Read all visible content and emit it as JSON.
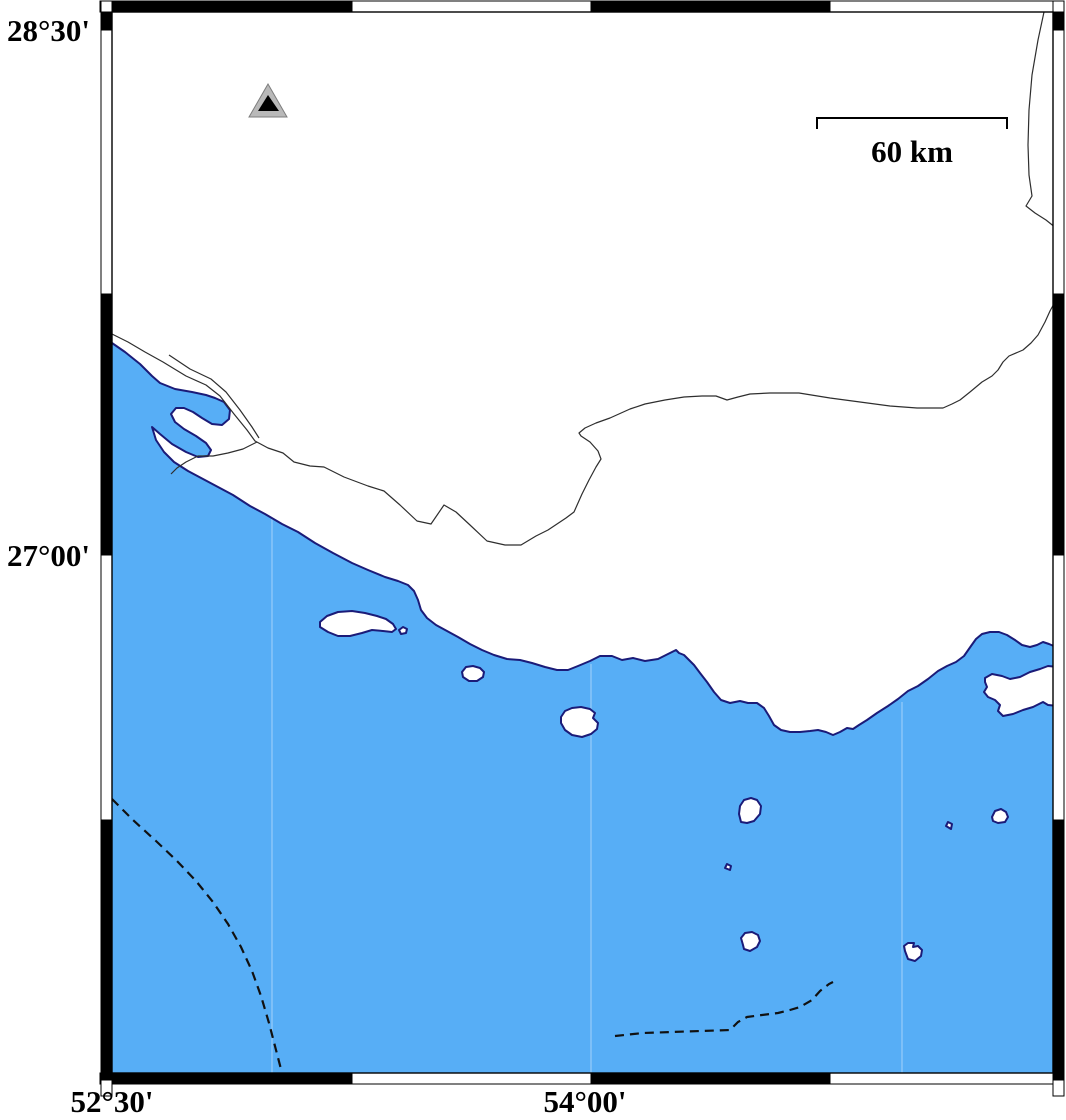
{
  "map": {
    "type": "coastal-reference-map",
    "labels": {
      "lat_top": "28°30'",
      "lat_mid": "27°00'",
      "lon_left": "52°30'",
      "lon_mid": "54°00'"
    },
    "scalebar": {
      "label": "60 km"
    },
    "marker": {
      "shape": "triangle",
      "outer_fill": "#b9b9b9",
      "inner_fill": "#000000"
    },
    "colors": {
      "sea": "#57aef6",
      "coast": "#1b1b78",
      "land": "#ffffff",
      "frame": "#000000",
      "border_line": "#2e2e2e",
      "dashed_line": "#111111"
    },
    "frame_style": "alternating-black-white-fancy-frame",
    "features": {
      "islands": 10,
      "dashed_boundaries": 2,
      "land_borders": 2
    }
  }
}
